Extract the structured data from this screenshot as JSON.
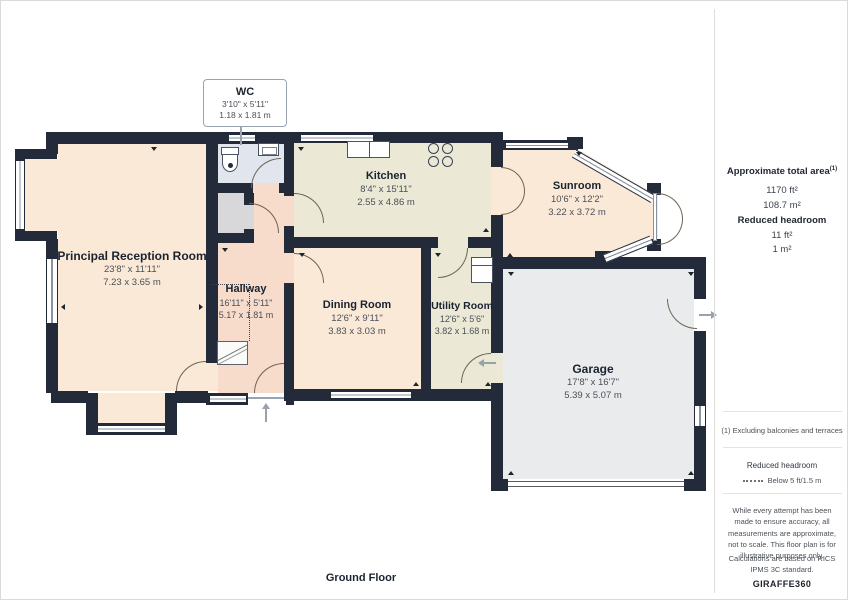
{
  "floor_label": "Ground Floor",
  "callout": {
    "name": "WC",
    "dims_ft": "3'10\" x 5'11\"",
    "dims_m": "1.18 x 1.81 m"
  },
  "rooms": [
    {
      "name": "Principal Reception Room",
      "dims_ft": "23'8\" x 11'11\"",
      "dims_m": "7.23 x 3.65 m"
    },
    {
      "name": "Hallway",
      "dims_ft": "16'11\" x 5'11\"",
      "dims_m": "5.17 x 1.81 m"
    },
    {
      "name": "Kitchen",
      "dims_ft": "8'4\" x 15'11\"",
      "dims_m": "2.55 x 4.86 m"
    },
    {
      "name": "Dining Room",
      "dims_ft": "12'6\" x 9'11\"",
      "dims_m": "3.83 x 3.03 m"
    },
    {
      "name": "Utility Room",
      "dims_ft": "12'6\" x 5'6\"",
      "dims_m": "3.82 x 1.68 m"
    },
    {
      "name": "Sunroom",
      "dims_ft": "10'6\" x 12'2\"",
      "dims_m": "3.22 x 3.72 m"
    },
    {
      "name": "Garage",
      "dims_ft": "17'8\" x 16'7\"",
      "dims_m": "5.39 x 5.07 m"
    }
  ],
  "sidebar": {
    "total_area_label": "Approximate total area",
    "total_area_sup": "(1)",
    "total_area_ft": "1170 ft²",
    "total_area_m": "108.7 m²",
    "reduced_label": "Reduced headroom",
    "reduced_ft": "11 ft²",
    "reduced_m": "1 m²",
    "footnote": "(1) Excluding balconies and terraces",
    "legend_title": "Reduced headroom",
    "legend_item": "Below 5 ft/1.5 m",
    "disclaimer": "While every attempt has been made to ensure accuracy, all measurements are approximate, not to scale. This floor plan is for illustrative purposes only.",
    "standard": "Calculations are based on RICS IPMS 3C standard.",
    "brand_1": "GIRAFFE",
    "brand_2": "360"
  },
  "colors": {
    "wall": "#232B3A",
    "reception_dining_sunroom": "#FBE9D8",
    "hallway": "#F7DCCC",
    "kitchen_utility": "#EBE9D6",
    "wc": "#E0E5EE",
    "storage": "#D8D8DA",
    "garage": "#EAEBEC",
    "door_arc": "#6F6457"
  }
}
